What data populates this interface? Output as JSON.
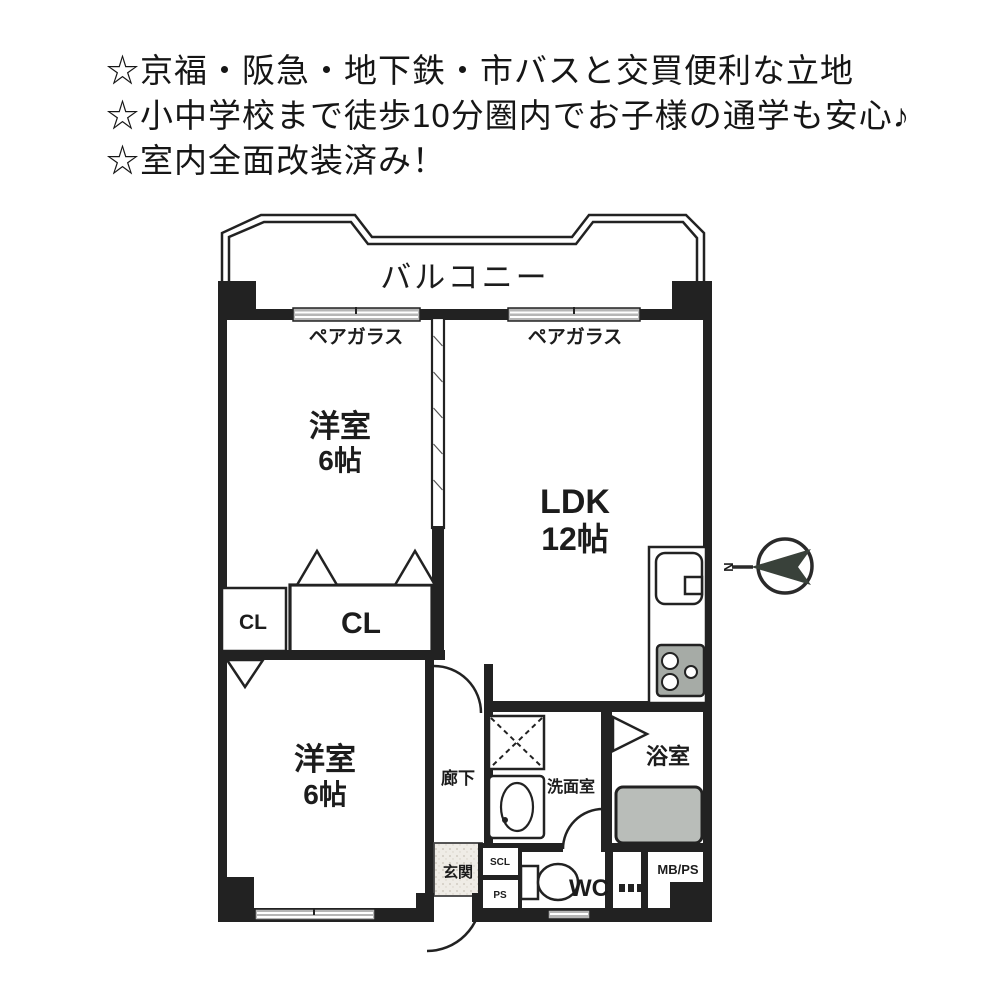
{
  "header": {
    "lines": [
      "☆京福・阪急・地下鉄・市バスと交買便利な立地",
      "☆小中学校まで徒歩10分圏内でお子様の通学も安心♪",
      "☆室内全面改装済み！"
    ]
  },
  "floorplan": {
    "balcony": "バルコニー",
    "pair_glass_left": "ペアガラス",
    "pair_glass_right": "ペアガラス",
    "bedroom_top": {
      "name": "洋室",
      "size": "6帖"
    },
    "ldk": {
      "name": "LDK",
      "size": "12帖"
    },
    "bedroom_bottom": {
      "name": "洋室",
      "size": "6帖"
    },
    "closet_left": "CL",
    "closet_right": "CL",
    "corridor": "廊下",
    "washroom": "洗面室",
    "bathroom": "浴室",
    "entrance": "玄関",
    "toilet": "WC",
    "shoe_closet": "SCL",
    "pipe_space": "PS",
    "meter_box": "MB/PS",
    "compass_north": "N",
    "colors": {
      "line": "#222222",
      "window_glass": "#b6b6b6",
      "bathtub": "#b9bdb9",
      "stove": "#a6aba6",
      "entrance_floor": "#efece6"
    }
  }
}
